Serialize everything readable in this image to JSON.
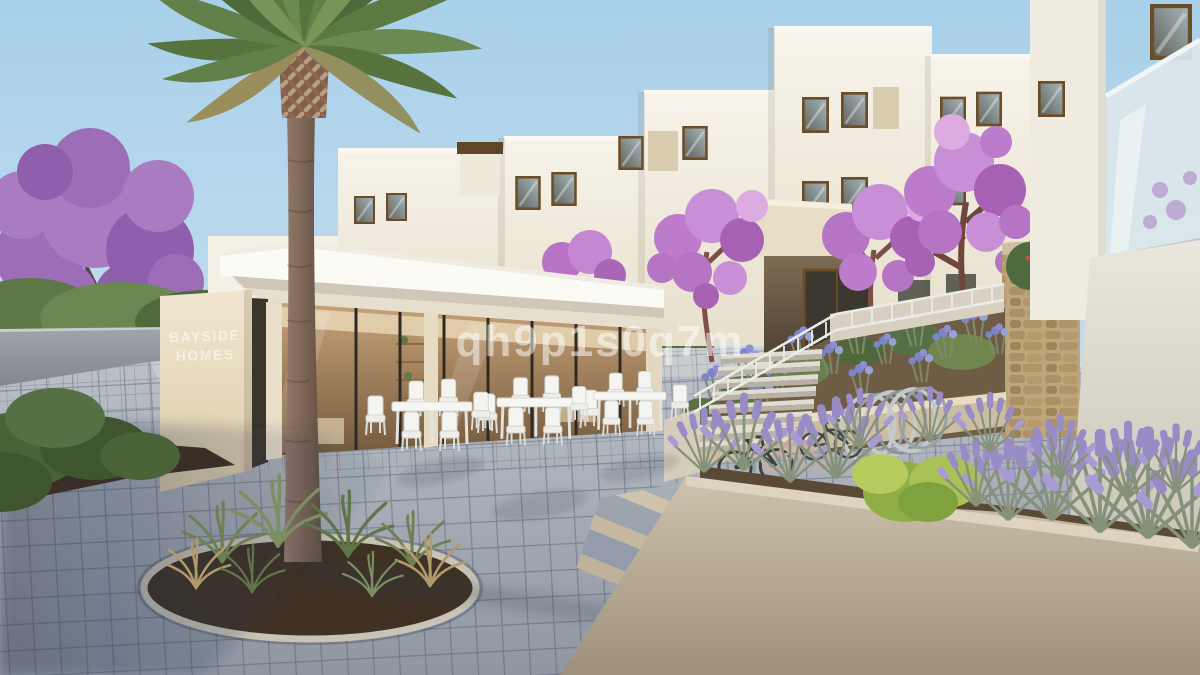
{
  "watermark": {
    "text": "qh9p1s0q7m"
  },
  "sign": {
    "line1": "BAYSIDE",
    "line2": "HOMES"
  },
  "palette": {
    "sky-top": "#a8d0ea",
    "sky-mid": "#c3ddee",
    "sky-bottom": "#e3eef4",
    "building": "#f5f1e7",
    "building-shade": "#e3dac7",
    "roof": "#fbfaf5",
    "frame-brown": "#6b4e28",
    "glass-dark": "#4a4a42",
    "accent-panel": "#d9cdb0",
    "wall-gray": "#8f949b",
    "jacaranda": "#9d6db8",
    "blossom": "#bd7ccb",
    "tree-green": "#5d7847",
    "pavement": "#a9b0ba",
    "pavement-shadow": "#6e7684",
    "planter-beige": "#b8ac97",
    "stone-tan": "#b2966c",
    "lavender": "#998cc6",
    "lavender-leaf": "#89947b",
    "agapanthus": "#7d84c9",
    "palm-green": "#5b7a42",
    "palm-trunk": "#80675a",
    "soil": "#4a3a2b",
    "step-light": "#ddd8cd",
    "furniture-white": "#f3f3f0",
    "bike-dark": "#3c4043",
    "watermark": "#ffffff"
  }
}
